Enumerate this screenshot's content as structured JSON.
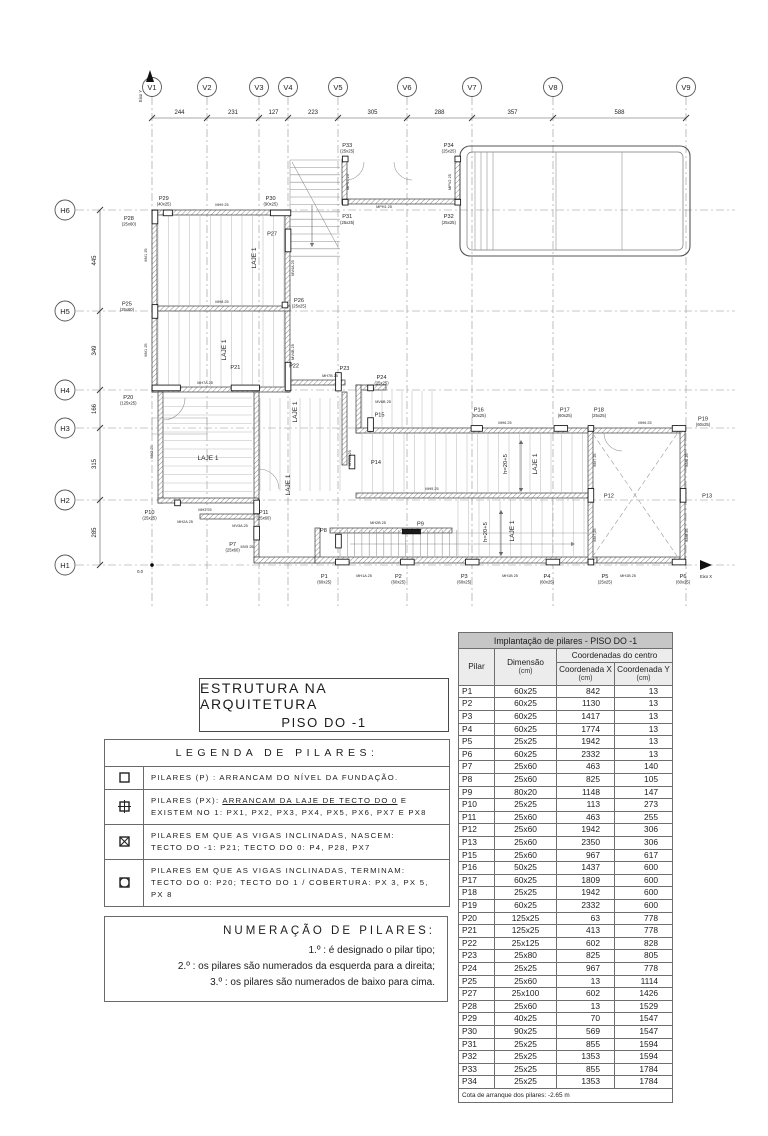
{
  "plan": {
    "axis": {
      "x_label": "Eixo X",
      "y_label": "Eixo Y",
      "origin": "0.0"
    },
    "grid_v": [
      {
        "id": "V1",
        "x": 152
      },
      {
        "id": "V2",
        "x": 207
      },
      {
        "id": "V3",
        "x": 259
      },
      {
        "id": "V4",
        "x": 288
      },
      {
        "id": "V5",
        "x": 338
      },
      {
        "id": "V6",
        "x": 407
      },
      {
        "id": "V7",
        "x": 472
      },
      {
        "id": "V8",
        "x": 553
      },
      {
        "id": "V9",
        "x": 686
      }
    ],
    "grid_h": [
      {
        "id": "H6",
        "y": 210
      },
      {
        "id": "H5",
        "y": 311
      },
      {
        "id": "H4",
        "y": 390
      },
      {
        "id": "H3",
        "y": 428
      },
      {
        "id": "H2",
        "y": 500
      },
      {
        "id": "H1",
        "y": 565
      }
    ],
    "dims_top": [
      "244",
      "231",
      "127",
      "223",
      "305",
      "288",
      "357",
      "588"
    ],
    "dims_left": [
      "445",
      "349",
      "166",
      "315",
      "285"
    ],
    "pillars": [
      {
        "id": "P1",
        "dim": "60x25",
        "X": 842,
        "Y": 13,
        "dx": -18,
        "dy": 16,
        "ld": "60x25"
      },
      {
        "id": "P2",
        "dim": "60x25",
        "X": 1130,
        "Y": 13,
        "dx": -9,
        "dy": 16,
        "ld": "60x25"
      },
      {
        "id": "P3",
        "dim": "60x25",
        "X": 1417,
        "Y": 13,
        "dx": -8,
        "dy": 16,
        "ld": "60x25"
      },
      {
        "id": "P4",
        "dim": "60x25",
        "X": 1774,
        "Y": 13,
        "dx": -6,
        "dy": 16,
        "ld": "60x25"
      },
      {
        "id": "P5",
        "dim": "25x25",
        "X": 1942,
        "Y": 13,
        "dx": 14,
        "dy": 16,
        "ld": "25x25"
      },
      {
        "id": "P6",
        "dim": "60x25",
        "X": 2332,
        "Y": 13,
        "dx": 4,
        "dy": 16,
        "ld": "60x25"
      },
      {
        "id": "P7",
        "dim": "25x60",
        "X": 463,
        "Y": 140,
        "dx": -24,
        "dy": 13,
        "ld": "25x60"
      },
      {
        "id": "P8",
        "dim": "25x60",
        "X": 825,
        "Y": 105,
        "dx": -15,
        "dy": -9
      },
      {
        "id": "P9",
        "dim": "80x20",
        "X": 1148,
        "Y": 147,
        "dx": 9,
        "dy": -6,
        "fill": 1
      },
      {
        "id": "P10",
        "dim": "25x25",
        "X": 113,
        "Y": 273,
        "dx": -28,
        "dy": 11,
        "ld": "25x25"
      },
      {
        "id": "P11",
        "dim": "25x60",
        "X": 463,
        "Y": 255,
        "dx": 7,
        "dy": 7,
        "ld": "25x60"
      },
      {
        "id": "P12",
        "dim": "25x60",
        "X": 1942,
        "Y": 306,
        "dx": 18,
        "dy": 2
      },
      {
        "id": "P13",
        "dim": "25x60",
        "X": 2350,
        "Y": 306,
        "dx": 24,
        "dy": 2
      },
      {
        "id": "P14",
        "dim": "25x60",
        "mx": 352,
        "my": 462,
        "dx": 24,
        "dy": 2
      },
      {
        "id": "P15",
        "dim": "25x60",
        "X": 967,
        "Y": 617,
        "dx": 9,
        "dy": -8
      },
      {
        "id": "P16",
        "dim": "50x25",
        "X": 1437,
        "Y": 600,
        "dx": 2,
        "dy": -17,
        "ld": "50x25"
      },
      {
        "id": "P17",
        "dim": "60x25",
        "X": 1809,
        "Y": 600,
        "dx": 4,
        "dy": -17,
        "ld": "60x25"
      },
      {
        "id": "P18",
        "dim": "25x25",
        "X": 1942,
        "Y": 600,
        "dx": 8,
        "dy": -17,
        "ld": "25x25"
      },
      {
        "id": "P19",
        "dim": "60x25",
        "X": 2332,
        "Y": 600,
        "dx": 24,
        "dy": -8,
        "ld": "60x25"
      },
      {
        "id": "P20",
        "dim": "125x25",
        "X": 63,
        "Y": 778,
        "dx": -38,
        "dy": 11,
        "ld": "125x25"
      },
      {
        "id": "P21",
        "dim": "125x25",
        "X": 413,
        "Y": 778,
        "dx": -10,
        "dy": -19
      },
      {
        "id": "P22",
        "dim": "25x125",
        "X": 602,
        "Y": 828,
        "dx": 6,
        "dy": -9
      },
      {
        "id": "P23",
        "dim": "25x80",
        "X": 825,
        "Y": 805,
        "dx": 6,
        "dy": -12
      },
      {
        "id": "P24",
        "dim": "25x25",
        "X": 967,
        "Y": 778,
        "dx": 11,
        "dy": -9,
        "ld": "25x25"
      },
      {
        "id": "P25",
        "dim": "25x60",
        "X": 13,
        "Y": 1114,
        "dx": -28,
        "dy": -6,
        "ld": "25x60"
      },
      {
        "id": "P26",
        "dim": "25x25",
        "mx": 285,
        "my": 305,
        "dx": 14,
        "dy": -3,
        "ld": "25x25"
      },
      {
        "id": "P27",
        "dim": "25x100",
        "X": 602,
        "Y": 1426,
        "dx": -16,
        "dy": -5
      },
      {
        "id": "P28",
        "dim": "25x60",
        "X": 13,
        "Y": 1529,
        "dx": -26,
        "dy": 3,
        "ld": "25x60"
      },
      {
        "id": "P29",
        "dim": "40x25",
        "X": 70,
        "Y": 1547,
        "dx": -4,
        "dy": -13,
        "ld": "40x25"
      },
      {
        "id": "P30",
        "dim": "90x25",
        "X": 569,
        "Y": 1547,
        "dx": -10,
        "dy": -13,
        "ld": "90x25"
      },
      {
        "id": "P31",
        "dim": "25x25",
        "X": 855,
        "Y": 1594,
        "dx": 2,
        "dy": 16,
        "ld": "25x25"
      },
      {
        "id": "P32",
        "dim": "25x25",
        "X": 1353,
        "Y": 1594,
        "dx": -9,
        "dy": 16,
        "ld": "25x25"
      },
      {
        "id": "P33",
        "dim": "25x25",
        "X": 855,
        "Y": 1784,
        "dx": 2,
        "dy": -12,
        "ld": "25x25"
      },
      {
        "id": "P34",
        "dim": "25x25",
        "X": 1353,
        "Y": 1784,
        "dx": -9,
        "dy": -12,
        "ld": "25x25"
      }
    ],
    "wall_labels": [
      {
        "t": "MH9 25",
        "x": 222,
        "y": 206
      },
      {
        "t": "MH8 25",
        "x": 222,
        "y": 303
      },
      {
        "t": "MH7A 25",
        "x": 205,
        "y": 384
      },
      {
        "t": "MH7B 25",
        "x": 330,
        "y": 377
      },
      {
        "t": "MPH1 25",
        "x": 384,
        "y": 208
      },
      {
        "t": "MPV1 25",
        "x": 349,
        "y": 182,
        "r": -90
      },
      {
        "t": "MPV2 25",
        "x": 451,
        "y": 182,
        "r": -90
      },
      {
        "t": "MV1 25",
        "x": 147,
        "y": 255,
        "r": -90
      },
      {
        "t": "MV1 25",
        "x": 147,
        "y": 350,
        "r": -90
      },
      {
        "t": "MV2 25",
        "x": 153,
        "y": 452,
        "r": -90
      },
      {
        "t": "MV3A 25",
        "x": 240,
        "y": 527
      },
      {
        "t": "MV4A 25",
        "x": 294,
        "y": 268,
        "r": -90
      },
      {
        "t": "MV4B 25",
        "x": 294,
        "y": 352,
        "r": -90
      },
      {
        "t": "MV5 25",
        "x": 247,
        "y": 548
      },
      {
        "t": "MV6A 25",
        "x": 351,
        "y": 458,
        "r": -90
      },
      {
        "t": "MV6B 25",
        "x": 383,
        "y": 403
      },
      {
        "t": "MH6 25",
        "x": 505,
        "y": 424
      },
      {
        "t": "MH6 25",
        "x": 645,
        "y": 424
      },
      {
        "t": "MH5 25",
        "x": 432,
        "y": 490
      },
      {
        "t": "MH3 25",
        "x": 205,
        "y": 511
      },
      {
        "t": "MH2A 25",
        "x": 185,
        "y": 523
      },
      {
        "t": "MH2B 25",
        "x": 378,
        "y": 524
      },
      {
        "t": "MH1A 25",
        "x": 364,
        "y": 577
      },
      {
        "t": "MH1B 25",
        "x": 510,
        "y": 577
      },
      {
        "t": "MH1B 25",
        "x": 628,
        "y": 577
      },
      {
        "t": "MV7 25",
        "x": 596,
        "y": 460,
        "r": -90
      },
      {
        "t": "MV7 25",
        "x": 596,
        "y": 535,
        "r": -90
      },
      {
        "t": "MV8 25",
        "x": 688,
        "y": 460,
        "r": -90
      },
      {
        "t": "MV8 25",
        "x": 688,
        "y": 535,
        "r": -90
      }
    ],
    "room_labels": [
      {
        "t": "LAJE 1",
        "x": 256,
        "y": 258,
        "r": -90
      },
      {
        "t": "LAJE 1",
        "x": 226,
        "y": 350,
        "r": -90
      },
      {
        "t": "LAJE 1",
        "x": 208,
        "y": 460,
        "r": 0
      },
      {
        "t": "LAJE 1",
        "x": 297,
        "y": 412,
        "r": -90
      },
      {
        "t": "LAJE 1",
        "x": 290,
        "y": 485,
        "r": -90
      },
      {
        "t": "LAJE 1",
        "x": 537,
        "y": 464,
        "r": -90
      },
      {
        "t": "LAJE 1",
        "x": 514,
        "y": 531,
        "r": -90
      },
      {
        "t": "h=20+5",
        "x": 507,
        "y": 464,
        "r": -90
      },
      {
        "t": "h=20+5",
        "x": 487,
        "y": 532,
        "r": -90
      }
    ]
  },
  "title_block": {
    "line1": "ESTRUTURA NA ARQUITETURA",
    "line2": "PISO DO -1"
  },
  "legend": {
    "header": "LEGENDA DE PILARES:",
    "items": [
      {
        "icon": "square-icon",
        "lines": [
          [
            {
              "t": "PILARES (P) : ARRANCAM DO NÍVEL DA FUNDAÇÃO."
            }
          ]
        ]
      },
      {
        "icon": "square-cross-icon",
        "lines": [
          [
            {
              "t": "PILARES (PX): "
            },
            {
              "t": "ARRANCAM DA LAJE DE TECTO DO 0",
              "u": true
            },
            {
              "t": " E"
            }
          ],
          [
            {
              "t": "EXISTEM NO 1: PX1, PX2, PX3, PX4, PX5, PX6, PX7 E PX8"
            }
          ]
        ]
      },
      {
        "icon": "square-x-icon",
        "lines": [
          [
            {
              "t": "PILARES EM QUE AS VIGAS INCLINADAS, NASCEM:"
            }
          ],
          [
            {
              "t": "TECTO DO -1: P21; TECTO DO 0: P4, P28, PX7"
            }
          ]
        ]
      },
      {
        "icon": "square-circle-icon",
        "lines": [
          [
            {
              "t": "PILARES EM QUE AS VIGAS INCLINADAS, TERMINAM:"
            }
          ],
          [
            {
              "t": "TECTO DO 0: P20; TECTO DO 1 / COBERTURA: PX 3, PX 5, PX 8"
            }
          ]
        ]
      }
    ]
  },
  "numbering": {
    "header": "NUMERAÇÃO DE PILARES:",
    "items": [
      "1.º : é designado o pilar tipo;",
      "2.º : os pilares são numerados da esquerda para a direita;",
      "3.º : os pilares são numerados de baixo para cima."
    ]
  },
  "table": {
    "title": "Implantação de pilares - PISO DO -1",
    "col_pilar": "Pilar",
    "col_dim": "Dimensão",
    "col_coords": "Coordenadas do centro",
    "col_x": "Coordenada X",
    "col_y": "Coordenada Y",
    "unit": "(cm)",
    "rows": [
      [
        "P1",
        "60x25",
        "842",
        "13"
      ],
      [
        "P2",
        "60x25",
        "1130",
        "13"
      ],
      [
        "P3",
        "60x25",
        "1417",
        "13"
      ],
      [
        "P4",
        "60x25",
        "1774",
        "13"
      ],
      [
        "P5",
        "25x25",
        "1942",
        "13"
      ],
      [
        "P6",
        "60x25",
        "2332",
        "13"
      ],
      [
        "P7",
        "25x60",
        "463",
        "140"
      ],
      [
        "P8",
        "25x60",
        "825",
        "105"
      ],
      [
        "P9",
        "80x20",
        "1148",
        "147"
      ],
      [
        "P10",
        "25x25",
        "113",
        "273"
      ],
      [
        "P11",
        "25x60",
        "463",
        "255"
      ],
      [
        "P12",
        "25x60",
        "1942",
        "306"
      ],
      [
        "P13",
        "25x60",
        "2350",
        "306"
      ],
      [
        "P15",
        "25x60",
        "967",
        "617"
      ],
      [
        "P16",
        "50x25",
        "1437",
        "600"
      ],
      [
        "P17",
        "60x25",
        "1809",
        "600"
      ],
      [
        "P18",
        "25x25",
        "1942",
        "600"
      ],
      [
        "P19",
        "60x25",
        "2332",
        "600"
      ],
      [
        "P20",
        "125x25",
        "63",
        "778"
      ],
      [
        "P21",
        "125x25",
        "413",
        "778"
      ],
      [
        "P22",
        "25x125",
        "602",
        "828"
      ],
      [
        "P23",
        "25x80",
        "825",
        "805"
      ],
      [
        "P24",
        "25x25",
        "967",
        "778"
      ],
      [
        "P25",
        "25x60",
        "13",
        "1114"
      ],
      [
        "P27",
        "25x100",
        "602",
        "1426"
      ],
      [
        "P28",
        "25x60",
        "13",
        "1529"
      ],
      [
        "P29",
        "40x25",
        "70",
        "1547"
      ],
      [
        "P30",
        "90x25",
        "569",
        "1547"
      ],
      [
        "P31",
        "25x25",
        "855",
        "1594"
      ],
      [
        "P32",
        "25x25",
        "1353",
        "1594"
      ],
      [
        "P33",
        "25x25",
        "855",
        "1784"
      ],
      [
        "P34",
        "25x25",
        "1353",
        "1784"
      ]
    ],
    "footer": "Cota de arranque dos pilares: -2.65 m"
  }
}
